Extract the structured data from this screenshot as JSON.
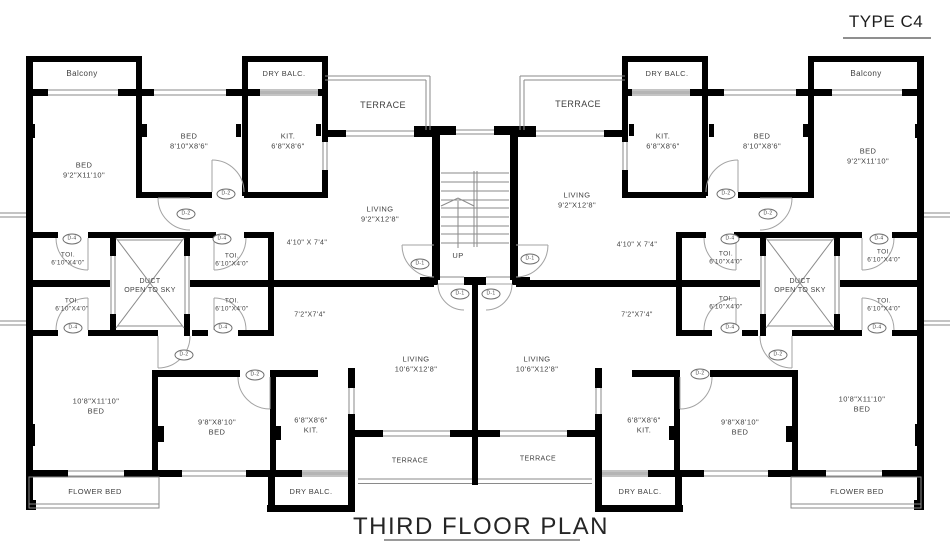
{
  "page": {
    "type_label": "TYPE C4",
    "title": "THIRD FLOOR PLAN"
  },
  "colors": {
    "wall": "#000000",
    "thin_line": "#8a8a8a",
    "door_arc": "#a3a3a3",
    "text": "#3f3f3f"
  },
  "room_labels": [
    {
      "name": "balcony-left",
      "text": "Balcony",
      "x": 82,
      "y": 74,
      "fs": 8
    },
    {
      "name": "dry-balc-top-left",
      "text": "DRY BALC.",
      "x": 284,
      "y": 74,
      "fs": 7.5
    },
    {
      "name": "bed-810-left",
      "text": "BED\n8'10\"X8'6\"",
      "x": 189,
      "y": 141,
      "fs": 7.5
    },
    {
      "name": "kit-top-left",
      "text": "KIT.\n6'8\"X8'6\"",
      "x": 288,
      "y": 141,
      "fs": 7.5
    },
    {
      "name": "bed-92-left",
      "text": "BED\n9'2\"X11'10\"",
      "x": 84,
      "y": 170,
      "fs": 7.5
    },
    {
      "name": "terrace-top-left",
      "text": "TERRACE",
      "x": 383,
      "y": 106,
      "fs": 9
    },
    {
      "name": "living-top-left",
      "text": "LIVING\n9'2\"X12'8\"",
      "x": 380,
      "y": 214,
      "fs": 7.5
    },
    {
      "name": "passage-left",
      "text": "4'10\" X 7'4\"",
      "x": 307,
      "y": 243,
      "fs": 7
    },
    {
      "name": "toi-top-outer-left",
      "text": "TOI.\n6'10\"X4'0\"",
      "x": 68,
      "y": 260,
      "fs": 6.5
    },
    {
      "name": "toi-top-inner-left",
      "text": "TOI.\n6'10\"X4'0\"",
      "x": 232,
      "y": 261,
      "fs": 6.5
    },
    {
      "name": "duct-left",
      "text": "DUCT\nOPEN TO SKY",
      "x": 150,
      "y": 286,
      "fs": 7
    },
    {
      "name": "toi-bot-outer-left",
      "text": "TOI.\n6'10\"X4'0\"",
      "x": 72,
      "y": 306,
      "fs": 6.5
    },
    {
      "name": "toi-bot-inner-left",
      "text": "TOI.\n6'10\"X4'0\"",
      "x": 232,
      "y": 306,
      "fs": 6.5
    },
    {
      "name": "corridor-left",
      "text": "7'2\"X7'4\"",
      "x": 310,
      "y": 315,
      "fs": 7
    },
    {
      "name": "living-bot-left",
      "text": "LIVING\n10'6\"X12'8\"",
      "x": 416,
      "y": 364,
      "fs": 7.5
    },
    {
      "name": "bed-108-left",
      "text": "10'8\"X11'10\"\nBED",
      "x": 96,
      "y": 406,
      "fs": 7.5
    },
    {
      "name": "bed-98-left",
      "text": "9'8\"X8'10\"\nBED",
      "x": 217,
      "y": 427,
      "fs": 7.5
    },
    {
      "name": "kit-bot-left",
      "text": "6'8\"X8'6\"\nKIT.",
      "x": 311,
      "y": 425,
      "fs": 7.5
    },
    {
      "name": "terrace-bot-left",
      "text": "TERRACE",
      "x": 410,
      "y": 461,
      "fs": 7
    },
    {
      "name": "flower-bed-left",
      "text": "FLOWER BED",
      "x": 95,
      "y": 492,
      "fs": 7.5
    },
    {
      "name": "dry-balc-bot-left",
      "text": "DRY BALC.",
      "x": 311,
      "y": 492,
      "fs": 7.5
    },
    {
      "name": "stairs-up",
      "text": "UP",
      "x": 458,
      "y": 256,
      "fs": 7.5
    },
    {
      "name": "balcony-right",
      "text": "Balcony",
      "x": 866,
      "y": 74,
      "fs": 8
    },
    {
      "name": "dry-balc-top-right",
      "text": "DRY BALC.",
      "x": 667,
      "y": 74,
      "fs": 7.5
    },
    {
      "name": "bed-810-right",
      "text": "BED\n8'10\"X8'6\"",
      "x": 762,
      "y": 141,
      "fs": 7.5
    },
    {
      "name": "kit-top-right",
      "text": "KIT.\n6'8\"X8'6\"",
      "x": 663,
      "y": 141,
      "fs": 7.5
    },
    {
      "name": "bed-92-right",
      "text": "BED\n9'2\"X11'10\"",
      "x": 868,
      "y": 156,
      "fs": 7.5
    },
    {
      "name": "terrace-top-right",
      "text": "TERRACE",
      "x": 578,
      "y": 105,
      "fs": 9
    },
    {
      "name": "living-top-right",
      "text": "LIVING\n9'2\"X12'8\"",
      "x": 577,
      "y": 200,
      "fs": 7.5
    },
    {
      "name": "passage-right",
      "text": "4'10\" X 7'4\"",
      "x": 637,
      "y": 245,
      "fs": 7
    },
    {
      "name": "toi-top-inner-right",
      "text": "TOI.\n6'10\"X4'0\"",
      "x": 726,
      "y": 259,
      "fs": 6.5
    },
    {
      "name": "toi-top-outer-right",
      "text": "TOI.\n6'10\"X4'0\"",
      "x": 884,
      "y": 257,
      "fs": 6.5
    },
    {
      "name": "duct-right",
      "text": "DUCT\nOPEN TO SKY",
      "x": 800,
      "y": 286,
      "fs": 7
    },
    {
      "name": "toi-bot-inner-right",
      "text": "TOI.\n6'10\"X4'0\"",
      "x": 726,
      "y": 304,
      "fs": 6.5
    },
    {
      "name": "toi-bot-outer-right",
      "text": "TOI.\n6'10\"X4'0\"",
      "x": 884,
      "y": 306,
      "fs": 6.5
    },
    {
      "name": "corridor-right",
      "text": "7'2\"X7'4\"",
      "x": 637,
      "y": 315,
      "fs": 7
    },
    {
      "name": "living-bot-right",
      "text": "LIVING\n10'6\"X12'8\"",
      "x": 537,
      "y": 364,
      "fs": 7.5
    },
    {
      "name": "bed-108-right",
      "text": "10'8\"X11'10\"\nBED",
      "x": 862,
      "y": 404,
      "fs": 7.5
    },
    {
      "name": "bed-98-right",
      "text": "9'8\"X8'10\"\nBED",
      "x": 740,
      "y": 427,
      "fs": 7.5
    },
    {
      "name": "kit-bot-right",
      "text": "6'8\"X8'6\"\nKIT.",
      "x": 644,
      "y": 425,
      "fs": 7.5
    },
    {
      "name": "terrace-bot-right",
      "text": "TERRACE",
      "x": 538,
      "y": 459,
      "fs": 7
    },
    {
      "name": "flower-bed-right",
      "text": "FLOWER BED",
      "x": 857,
      "y": 492,
      "fs": 7.5
    },
    {
      "name": "dry-balc-bot-right",
      "text": "DRY BALC.",
      "x": 640,
      "y": 492,
      "fs": 7.5
    }
  ],
  "door_tags": [
    {
      "text": "D-2",
      "x": 226,
      "y": 194
    },
    {
      "text": "D-2",
      "x": 186,
      "y": 214
    },
    {
      "text": "D-4",
      "x": 72,
      "y": 239
    },
    {
      "text": "D-4",
      "x": 222,
      "y": 239
    },
    {
      "text": "D-4",
      "x": 73,
      "y": 328
    },
    {
      "text": "D-4",
      "x": 223,
      "y": 328
    },
    {
      "text": "D-2",
      "x": 184,
      "y": 355
    },
    {
      "text": "D-2",
      "x": 255,
      "y": 375
    },
    {
      "text": "D-1",
      "x": 420,
      "y": 264
    },
    {
      "text": "D-1",
      "x": 460,
      "y": 294
    },
    {
      "text": "D-1",
      "x": 491,
      "y": 294
    },
    {
      "text": "D-1",
      "x": 530,
      "y": 259
    },
    {
      "text": "D-2",
      "x": 726,
      "y": 194
    },
    {
      "text": "D-2",
      "x": 768,
      "y": 214
    },
    {
      "text": "D-4",
      "x": 730,
      "y": 239
    },
    {
      "text": "D-4",
      "x": 879,
      "y": 239
    },
    {
      "text": "D-4",
      "x": 730,
      "y": 328
    },
    {
      "text": "D-4",
      "x": 877,
      "y": 328
    },
    {
      "text": "D-2",
      "x": 778,
      "y": 355
    },
    {
      "text": "D-2",
      "x": 700,
      "y": 374
    }
  ]
}
